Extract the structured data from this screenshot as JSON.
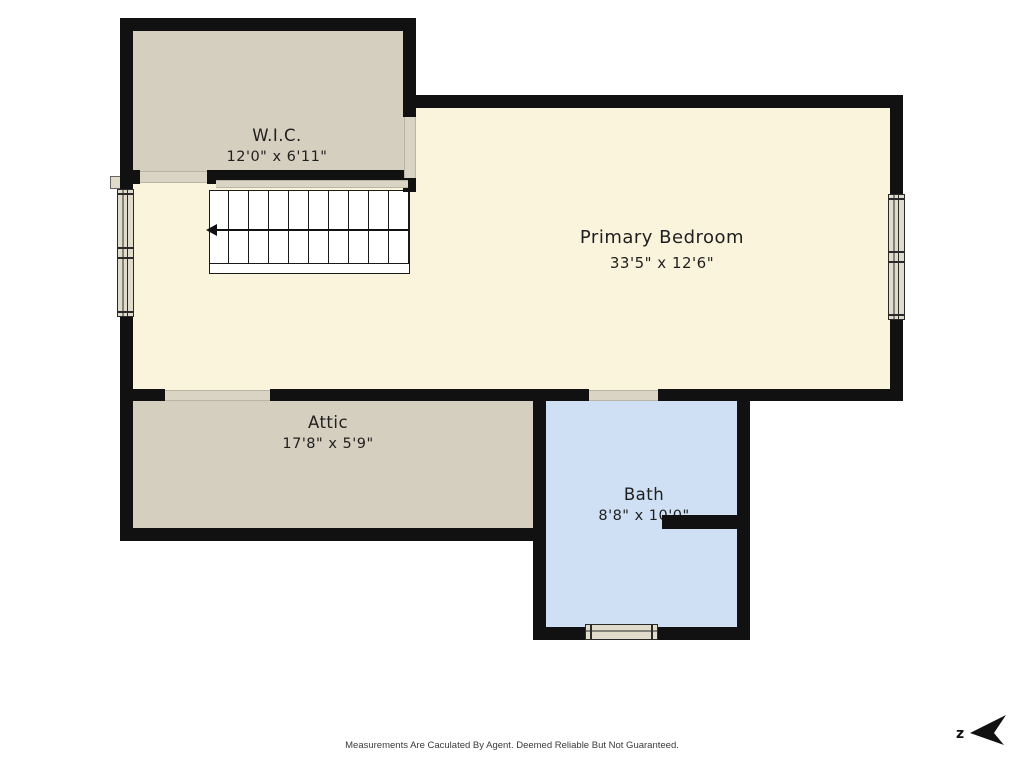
{
  "rooms": [
    {
      "name": "W.I.C.",
      "dims": "12'0\" x 6'11\""
    },
    {
      "name": "Primary Bedroom",
      "dims": "33'5\" x 12'6\""
    },
    {
      "name": "Attic",
      "dims": "17'8\" x 5'9\""
    },
    {
      "name": "Bath",
      "dims": "8'8\" x 10'0\""
    }
  ],
  "compass": {
    "label": "z"
  },
  "footer": {
    "disclaimer": "Measurements Are Caculated By Agent. Deemed Reliable But Not Guaranteed."
  },
  "colors": {
    "wall": "#111111",
    "closet": "#d5cfbf",
    "bedroom": "#faf4dc",
    "bath": "#cfe0f5",
    "window": "#e0dbca",
    "threshold": "#d9d4c4"
  }
}
